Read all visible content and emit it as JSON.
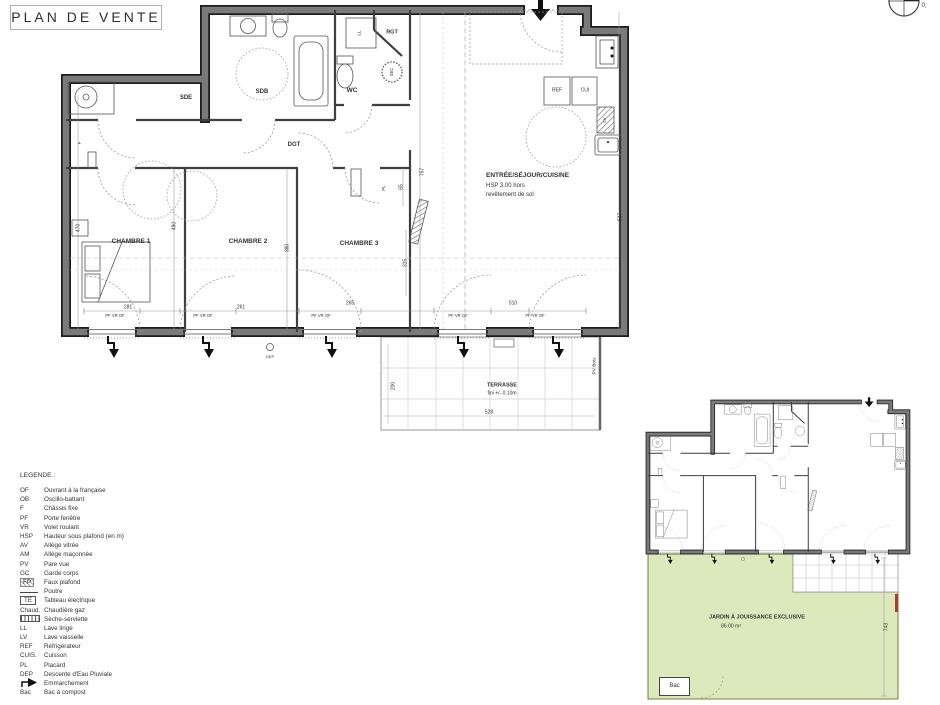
{
  "title": "PLAN DE VENTE",
  "corner_mark": "0,",
  "main_plan": {
    "rooms": {
      "sde": "SDE",
      "sdb": "SDB",
      "wc": "WC",
      "rgt": "RGT",
      "dgt": "DGT",
      "ch1": "CHAMBRE 1",
      "ch2": "CHAMBRE 2",
      "ch3": "CHAMBRE 3"
    },
    "sejour": {
      "title": "ENTRÉE/SÉJOUR/CUISINE",
      "hsp": "HSP 3.00 hors",
      "hsp2": "revêtement de sol"
    },
    "fixtures": {
      "ll": "LL",
      "sec": "SEC",
      "ref": "REF",
      "cui": "CUI",
      "lv": "LV",
      "pl": "PL",
      "f": "F",
      "dep": "DEP"
    },
    "window_label": "PF VR OF",
    "dims": {
      "left": "470",
      "ch1": "490",
      "ch2": "380",
      "ch3": "315",
      "pl": "65",
      "sejour": "757",
      "right": "537",
      "w1": "281",
      "w2": "261",
      "w3": "265",
      "w4": "510"
    }
  },
  "terrace": {
    "label": "TERRASSE",
    "finish": "fini +/- 0.10m",
    "width": "528",
    "depth": "200",
    "fence": "PV Bois"
  },
  "key_plan": {
    "garden": "JARDIN À JOUISSANCE EXCLUSIVE",
    "area": "86.00 m²",
    "depth": "743",
    "bac": "Bac"
  },
  "legend": {
    "heading": "LEGENDE :",
    "items": [
      {
        "abbr": "OF",
        "label": "Ouvrant à la française"
      },
      {
        "abbr": "OB",
        "label": "Oscillo-battant"
      },
      {
        "abbr": "F",
        "label": "Châssis fixe"
      },
      {
        "abbr": "PF",
        "label": "Porte fenêtre"
      },
      {
        "abbr": "VR",
        "label": "Volet roulant"
      },
      {
        "abbr": "HSP",
        "label": "Hauteur sous plafond (en m)"
      },
      {
        "abbr": "AV",
        "label": "Allège vitrée"
      },
      {
        "abbr": "AM",
        "label": "Allège maçonnée"
      },
      {
        "abbr": "PV",
        "label": "Pare vue"
      },
      {
        "abbr": "GC",
        "label": "Garde corps"
      },
      {
        "abbr": "FP",
        "label": "Faux plafond"
      },
      {
        "abbr": "",
        "label": "Poutre"
      },
      {
        "abbr": "TE",
        "label": "Tableau électrique"
      },
      {
        "abbr": "Chaud.",
        "label": "Chaudière gaz"
      },
      {
        "abbr": "",
        "label": "Sèche-serviette"
      },
      {
        "abbr": "LL",
        "label": "Lave linge"
      },
      {
        "abbr": "LV",
        "label": "Lave vaisselle"
      },
      {
        "abbr": "REF",
        "label": "Réfrigérateur"
      },
      {
        "abbr": "CUIS.",
        "label": "Cuisson"
      },
      {
        "abbr": "PL",
        "label": "Placard"
      },
      {
        "abbr": "DEP",
        "label": "Descente d'Eau Pluviale"
      },
      {
        "abbr": "",
        "label": "Emmarchement"
      },
      {
        "abbr": "Bac",
        "label": "Bac à compost"
      }
    ]
  }
}
